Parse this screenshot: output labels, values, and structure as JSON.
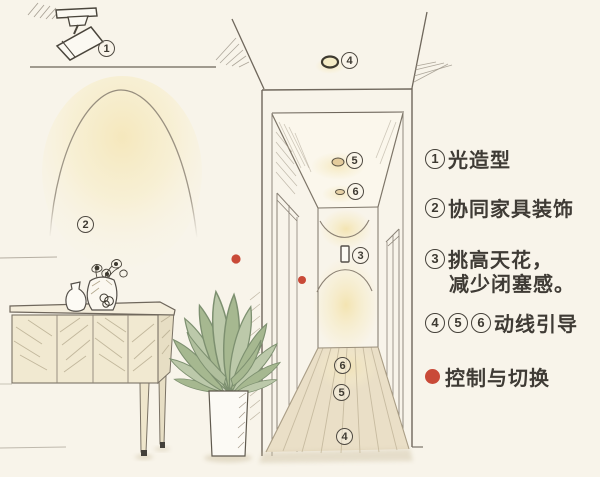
{
  "colors": {
    "background": "#f8f4ea",
    "glow_yellow": "#f6e9c0",
    "accent_red": "#c94a38",
    "ink": "#3f3b35",
    "wood_floor": "#eadfc7",
    "leaf_green": "#b9c7a6",
    "cabinet_cream": "#f1e9d1"
  },
  "scene": {
    "icons": {
      "spotlight": "track-spotlight-icon",
      "ceiling_light": "ceiling-light-icon",
      "downlight": "downlight-icon",
      "sconce": "wall-sconce-icon",
      "control_dot": "control-point-dot"
    },
    "labels": {
      "spotlight": "1",
      "wall_wash": "2",
      "end_wall_sconce": "3",
      "entry_ceiling_light": "4",
      "hall_downlight_upper": "5",
      "hall_downlight_lower": "6",
      "floor_pool_far": "6",
      "floor_pool_mid": "5",
      "floor_pool_near": "4"
    }
  },
  "legend": {
    "items": [
      {
        "num": "1",
        "text": "光造型"
      },
      {
        "num": "2",
        "text": "协同家具装饰"
      },
      {
        "num": "3",
        "text": "挑高天花，",
        "text2": "减少闭塞感。"
      },
      {
        "nums": [
          "4",
          "5",
          "6"
        ],
        "text": "动线引导"
      },
      {
        "text": "控制与切换"
      }
    ]
  }
}
